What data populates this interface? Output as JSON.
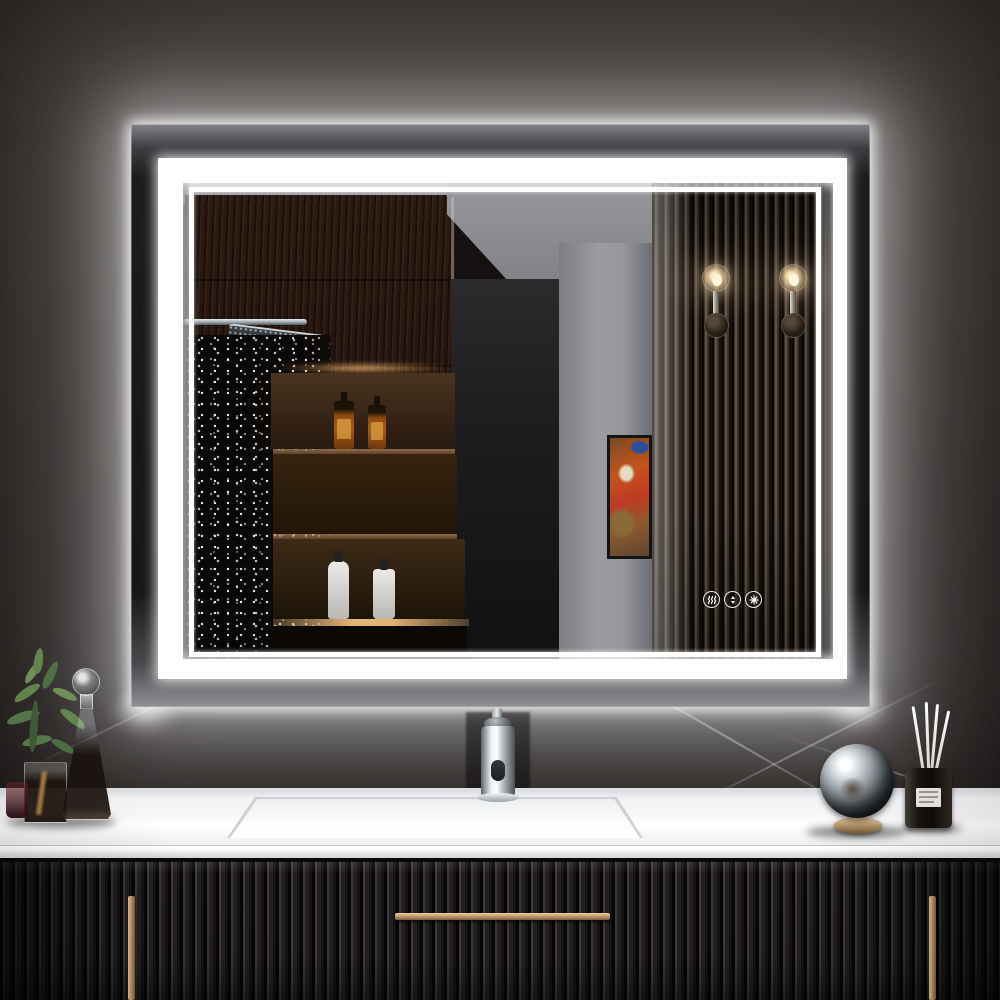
{
  "meta": {
    "type": "product-photo",
    "subject": "LED backlit rectangular bathroom vanity mirror",
    "description": "Glowing white front-lit and backlit LED mirror on a dark wall above a black fluted floating vanity with white countertop"
  },
  "visible_text": [],
  "mirror": {
    "led_color": "#ffffff",
    "frame_style": "double rectangular LED band with outer halo glow",
    "touch_buttons": [
      {
        "name": "defogger-button",
        "icon": "defog-icon",
        "title": "Anti-fog touch control"
      },
      {
        "name": "brightness-button",
        "icon": "brightness-up-down-icon",
        "title": "Dimmer touch control"
      },
      {
        "name": "color-temp-button",
        "icon": "color-temperature-icon",
        "title": "Color temperature touch control"
      }
    ],
    "reflection_items": [
      "gray ceiling",
      "dark wood tall cabinets",
      "chrome rain shower head",
      "glass shower panel with water droplets",
      "warm under-shelf lighting",
      "two amber pump soap bottles on upper shelf",
      "two white bottles on lower shelf",
      "gray wall with framed abstract artwork",
      "vertical wood slat accent panel",
      "two glass globe wall sconces"
    ]
  },
  "vanity": {
    "countertop": "white integrated-sink countertop",
    "sink": "rectangular integrated basin",
    "faucet": "polished chrome single-hole faucet",
    "cabinet": "black fluted reeded front",
    "handles": [
      {
        "name": "left-door-handle",
        "style": "vertical gold bar"
      },
      {
        "name": "center-drawer-handle",
        "style": "horizontal gold bar"
      },
      {
        "name": "right-door-handle",
        "style": "vertical gold bar"
      }
    ]
  },
  "decor": {
    "left": [
      "green sprig plant in glass cube vase",
      "tall glass decanter with sphere stopper",
      "small ruby glass"
    ],
    "right": [
      "mirrored chrome sphere on gold ring stand",
      "black reed diffuser with white reeds"
    ]
  },
  "colors": {
    "wall-top": "#2a2522",
    "wall-bottom": "#171312",
    "led": "#ffffff",
    "mirror-face": "#141110",
    "ceiling": "#94959a",
    "graywall": "#95969b",
    "wood": "#241610",
    "warmlight": "#e0a868",
    "slat-light": "#5f5144",
    "slat-dark": "#0b0807",
    "counter": "#f7f7f8",
    "cabinet": "#242021",
    "gold": "#c59e72",
    "leaf": "#63854f",
    "amber": "#a85a16",
    "chrome": "#c9ced2"
  }
}
